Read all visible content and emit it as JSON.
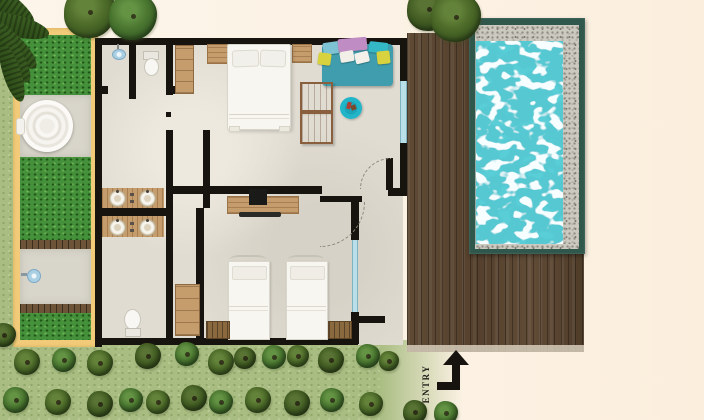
{
  "meta": {
    "kind": "floor-plan",
    "view": "top-down architectural plan",
    "subject": "two-bedroom pool villa with wooden deck, plunge pool, garden courtyard and outdoor bathtub"
  },
  "labels": {
    "entry": "ENTRY"
  },
  "palette": {
    "background": "#fcf2e6",
    "lawn": "#a9bd82",
    "garden_grass": "#45903a",
    "sand_border": "#f1cb79",
    "wall": "#17130e",
    "floor": "#e0dcd2",
    "deck_wood": "#5b4733",
    "pool_frame": "#30574b",
    "pool_water": "#55c8d2",
    "gravel": "#ccc9c0",
    "glass": "#b9dfe9",
    "furniture_wood": "#c59c6c",
    "daybed": "#3f9dad",
    "ottoman": "#22b5c9",
    "linen": "#f7f6f1",
    "tree": "#4f6b2a"
  },
  "rooms": [
    "master bedroom",
    "twin bedroom",
    "bathroom with double vanity",
    "second bathroom with double vanity",
    "shower room",
    "wc",
    "wardrobe corridor",
    "entry corridor",
    "garden courtyard with round bathtub",
    "outdoor shower court",
    "pool deck"
  ],
  "objects": [
    "double bed",
    "twin bed x2",
    "day bed with cushions",
    "round ottoman",
    "dresser cabinets x2",
    "tv console with tv",
    "double vanity x2",
    "toilet x2",
    "wardrobe x2",
    "round outdoor bathtub",
    "outdoor shower head",
    "indoor shower head",
    "plunge pool with pebble surround",
    "timber deck",
    "entry arrow",
    "garden trees",
    "palm fronds",
    "benches x2",
    "sliding glass door",
    "glass window",
    "swing doors x2"
  ]
}
